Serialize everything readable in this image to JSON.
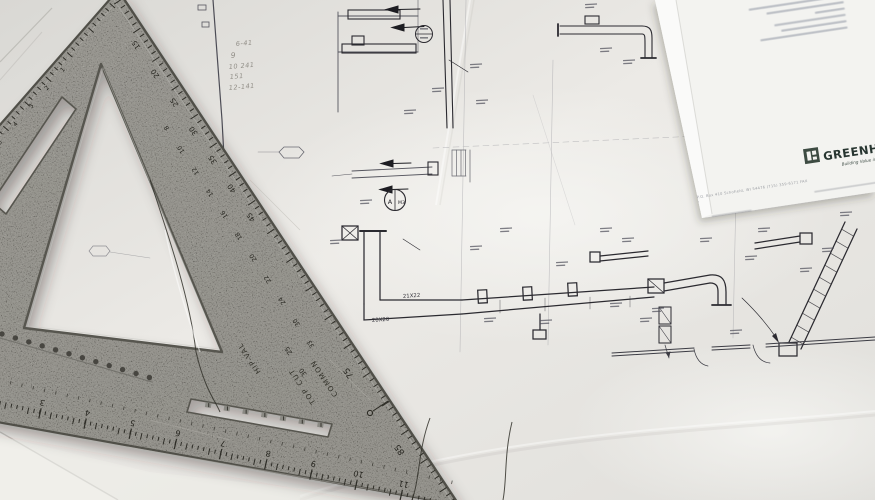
{
  "scene": {
    "description": "Photograph of HVAC construction blueprints on a desk with a gray metal speed square lying on top",
    "colors": {
      "paper": "#e4e3df",
      "paper_bright": "#f3f3f0",
      "blueprint_line": "#5f5f68",
      "duct_line": "#2b2a30",
      "square_body": "#8e8d86",
      "square_edge": "#504f48",
      "engraving": "#26251f",
      "brand_green": "#3d4b42",
      "pencil": "#8f8c85"
    }
  },
  "blueprint": {
    "duct_labels": {
      "main_vertical": "21X22",
      "main_elbow": "20X20"
    },
    "callout_circle": {
      "left": "A",
      "right": "M3"
    },
    "handwritten_notes": [
      "6-41",
      "9",
      "10 241",
      "151",
      "12-141"
    ]
  },
  "letterhead": {
    "brand": "GREENHECK",
    "tagline": "Building Value in Air.",
    "address_line": "P.O. Box 410   Schofield, WI 54476   (715) 359-6171   FAX",
    "blurred_contact_lines": 6
  },
  "speed_square": {
    "labels": {
      "common": "COMMON",
      "top_cut": "TOP CUT",
      "hip_val": "HIP-VAL"
    },
    "degree_numbers": [
      "15",
      "20",
      "25",
      "30",
      "35",
      "40",
      "45",
      "75",
      "85"
    ],
    "inch_numbers": [
      "2",
      "3",
      "4",
      "5",
      "6",
      "7",
      "8",
      "9",
      "10",
      "11"
    ],
    "inner_numbers": [
      "8",
      "10",
      "12",
      "14",
      "16",
      "18",
      "20",
      "22",
      "24",
      "30",
      "33"
    ],
    "pitch_numbers": [
      "25",
      "30"
    ],
    "left_arm_numbers": [
      "1",
      "2",
      "3",
      "4",
      "5",
      "6",
      "7"
    ]
  }
}
